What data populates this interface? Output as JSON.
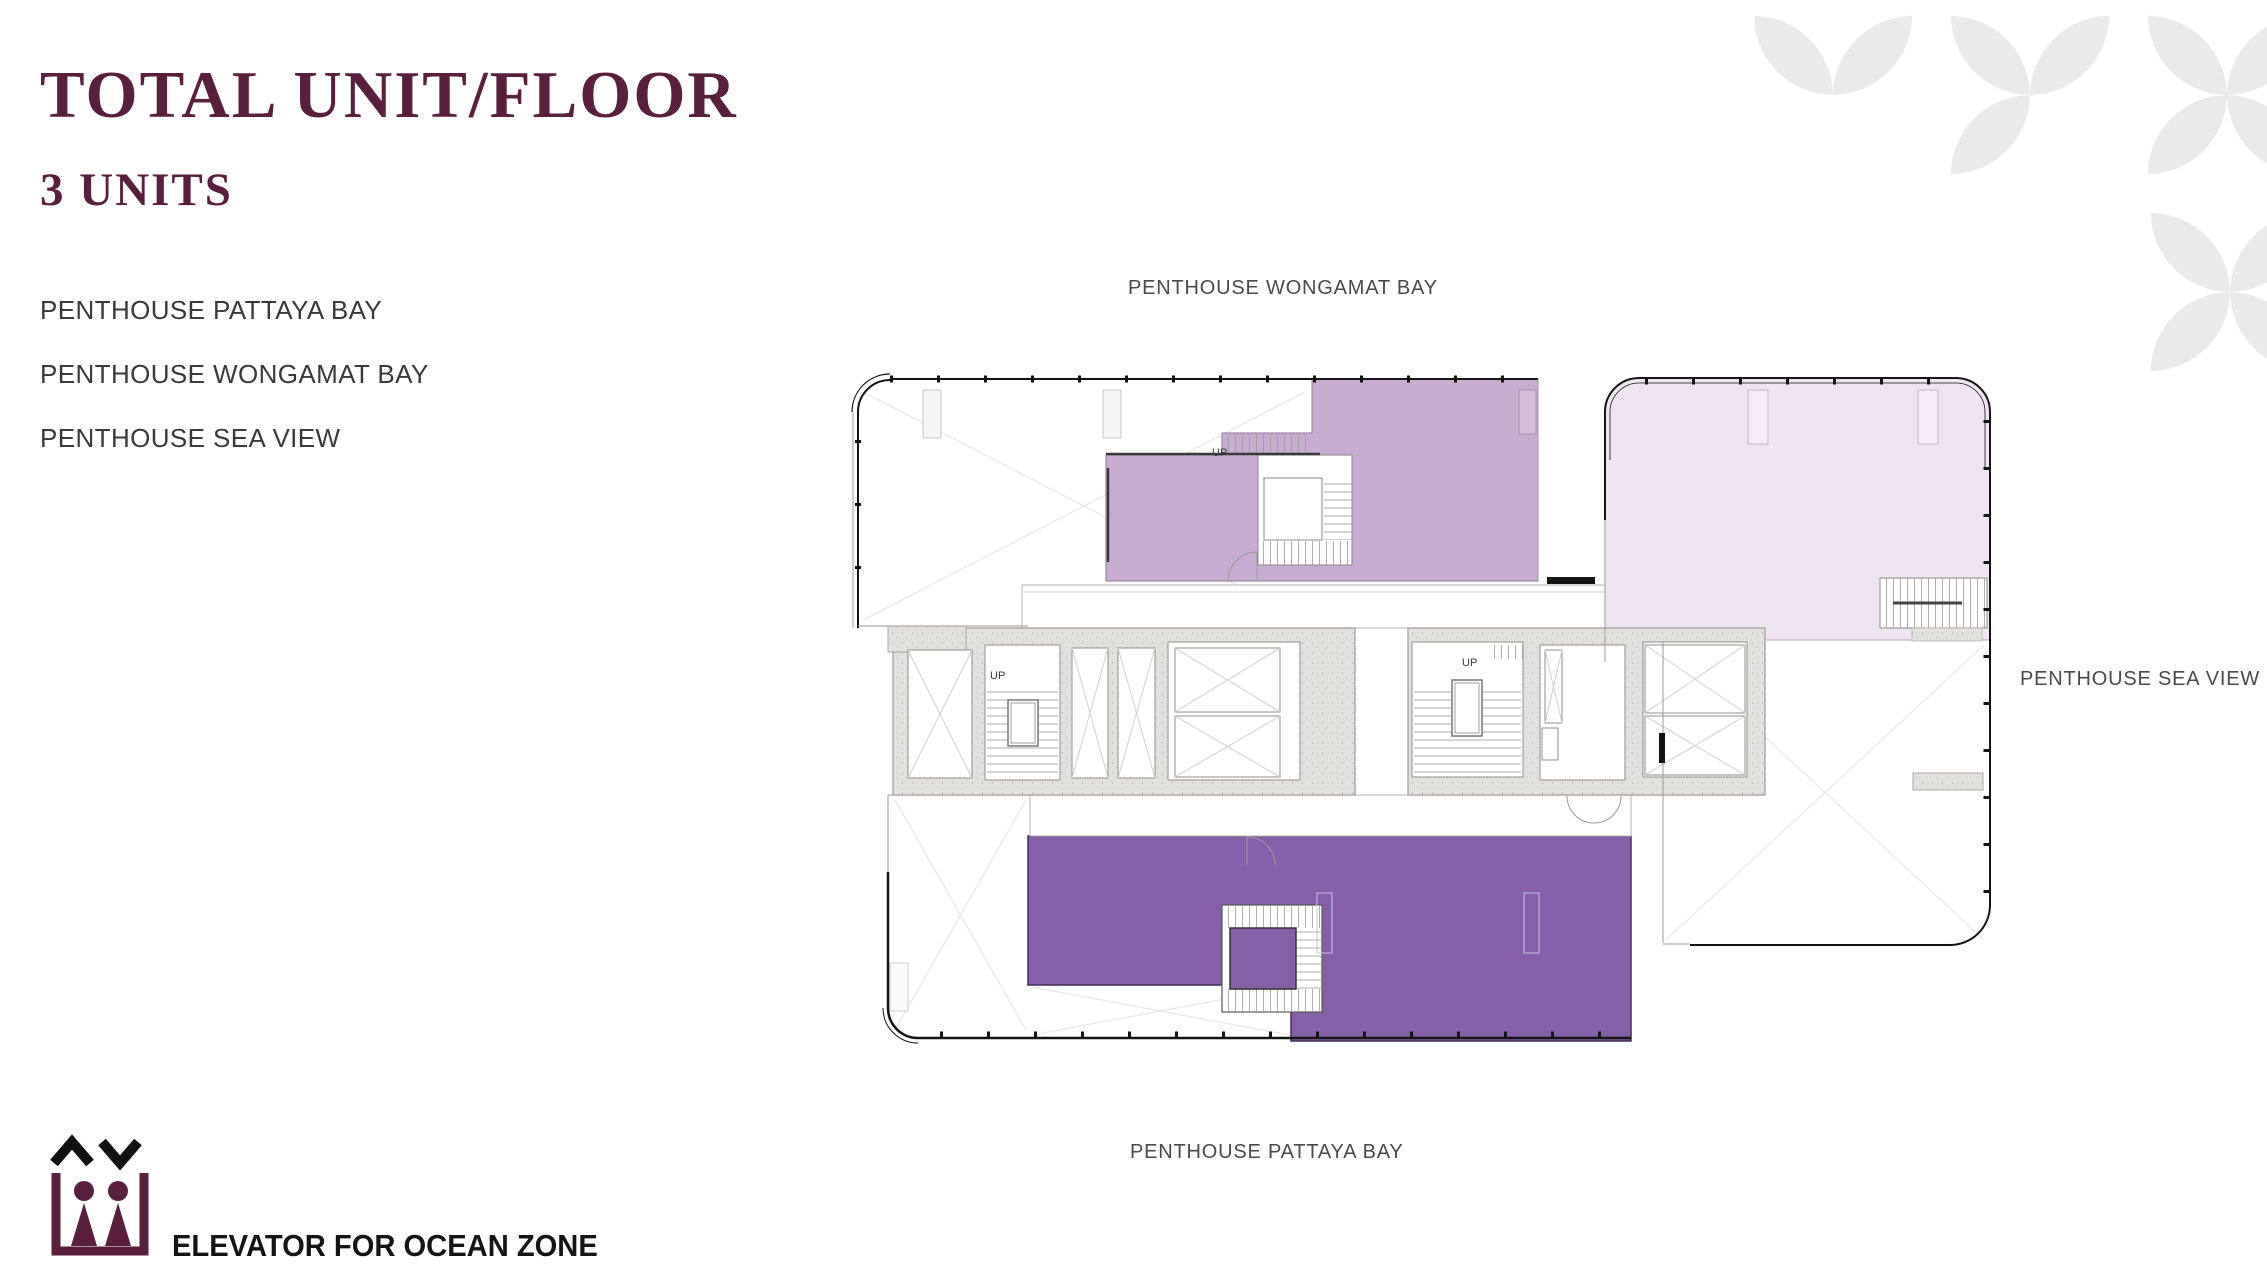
{
  "header": {
    "title": "TOTAL UNIT/FLOOR",
    "subtitle": "3 UNITS"
  },
  "units": {
    "items": [
      "PENTHOUSE PATTAYA BAY",
      "PENTHOUSE WONGAMAT BAY",
      "PENTHOUSE SEA VIEW"
    ]
  },
  "plan": {
    "label_top": "PENTHOUSE WONGAMAT BAY",
    "label_right": "PENTHOUSE SEA VIEW",
    "label_bottom": "PENTHOUSE PATTAYA BAY",
    "stair_label": "UP"
  },
  "legend": {
    "label": "ELEVATOR FOR OCEAN ZONE"
  },
  "colors": {
    "brand": "#591F3D",
    "unit_wongamat": "#C9ACD2",
    "unit_sea_view": "#EFE4F1",
    "unit_pattaya": "#8560A8",
    "decor_petal": "#E9E9E9",
    "plan_line": "#9a9a9a",
    "plan_outline": "#141414"
  }
}
